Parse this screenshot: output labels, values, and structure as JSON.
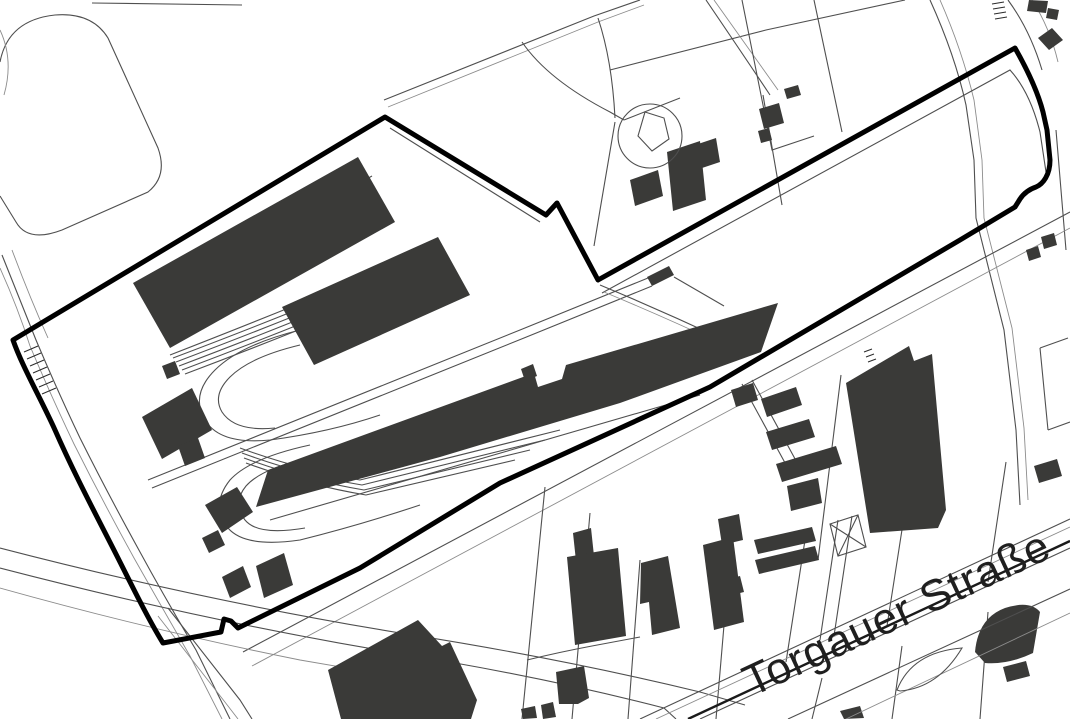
{
  "page": {
    "type": "cadastral-site-plan",
    "background": "#ffffff"
  },
  "map": {
    "street_label": "Torgauer Straße",
    "colors": {
      "background": "#ffffff",
      "building": "#3a3a38",
      "boundary": "#000000",
      "line": "#4f4f4f",
      "line_light": "#8c8c8c",
      "rail": "#1a1a1a",
      "label": "#1f1f1f"
    },
    "features": [
      {
        "name": "site-boundary",
        "kind": "thick-black-outline"
      },
      {
        "name": "building-footprints",
        "kind": "dark-filled-polygons"
      },
      {
        "name": "railway-sidings",
        "kind": "curved-loop-tracks"
      },
      {
        "name": "street-torgauer-strasse",
        "kind": "road-with-label"
      },
      {
        "name": "parcel-lines",
        "kind": "thin-gray-lines"
      },
      {
        "name": "circular-tank",
        "kind": "circle-outline"
      }
    ]
  }
}
